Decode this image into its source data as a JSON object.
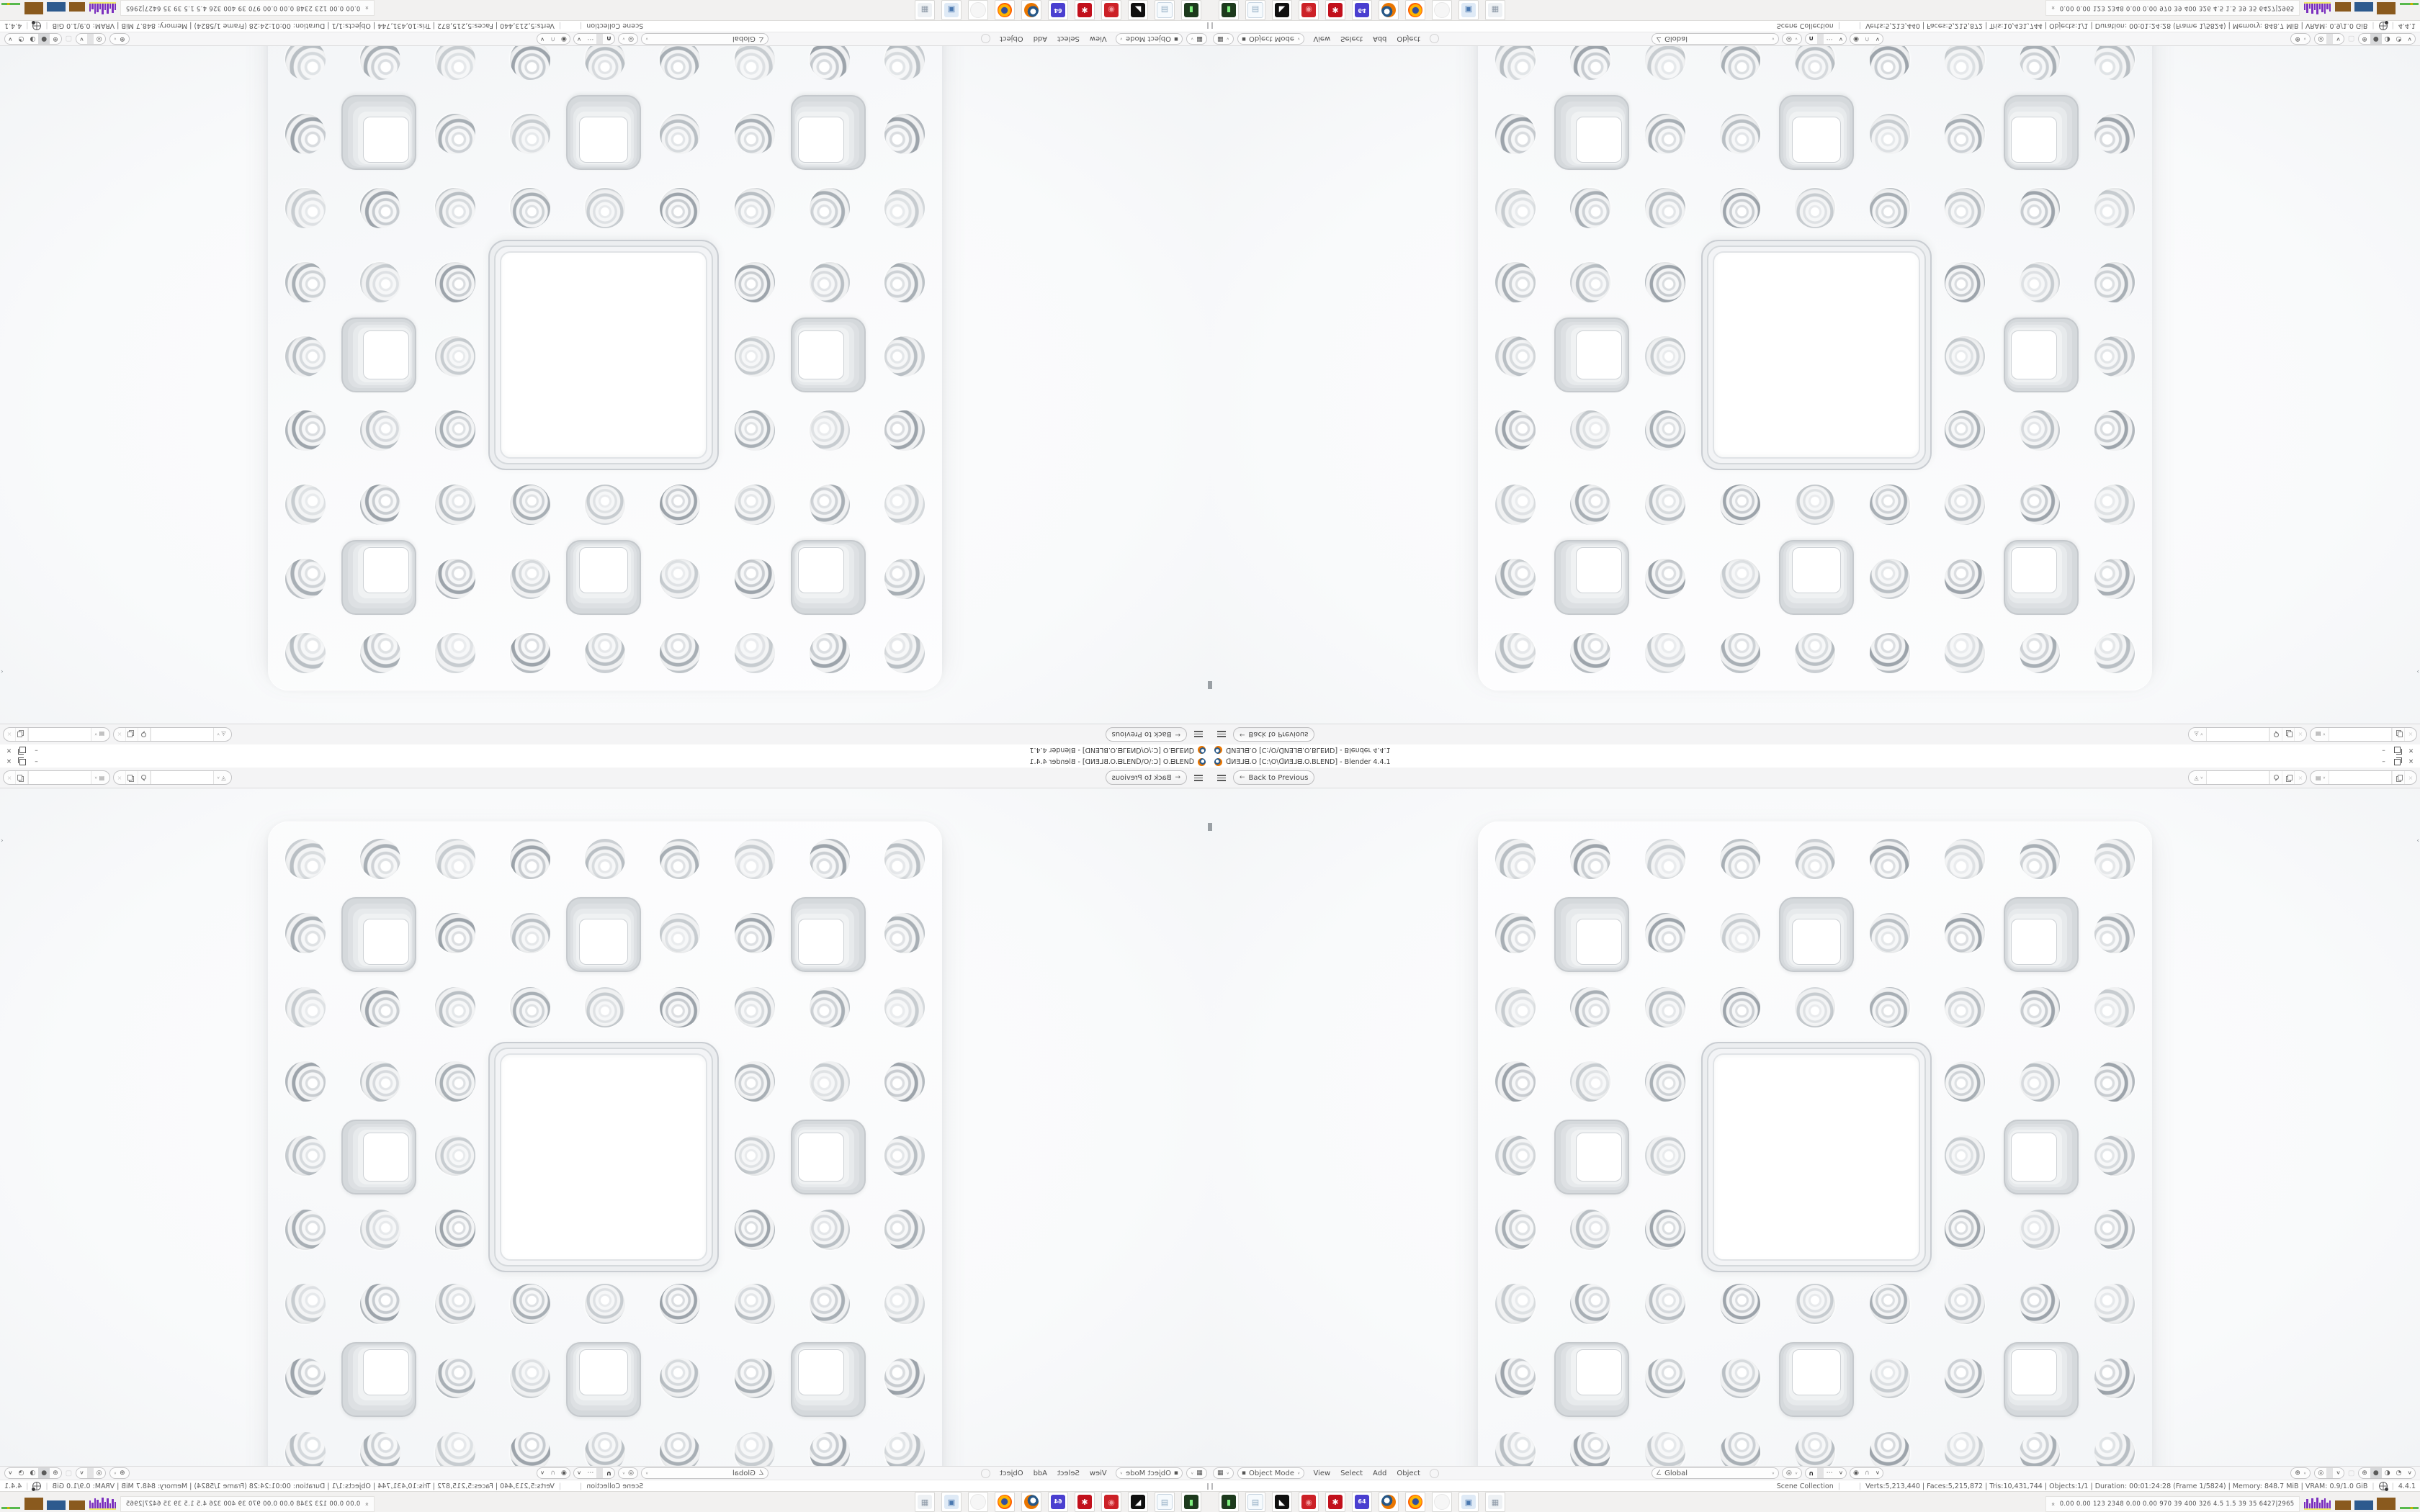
{
  "meta": {
    "app": "Blender",
    "composition": "Single 1680x1050 Blender fullscreen screenshot tiled 2x2 with mirror symmetry",
    "quadrants": [
      "top-left rotated 180",
      "top-right flipped vertically",
      "bottom-left flipped horizontally",
      "bottom-right original"
    ]
  },
  "colors": {
    "accent_orange": "#ea7600",
    "ui_text": "#4a4a4a",
    "topbar_bg": "#f4f4f5",
    "viewport_bg": "#fafbfc",
    "slab": "#fcfcfd",
    "ring_gray": "#aab1b7",
    "tray_purple": "#7b2fbe",
    "tray_brown": "#8a5a1e",
    "tray_blue": "#2d5a8e",
    "tray_yellow": "#f0ec6a",
    "tray_green": "#57b94c"
  },
  "window": {
    "title": "ᗡИƎ⅃ᗺ.O [C:\\O\\ᗡИƎ⅃ᗺ.O.BLEND] - Blender 4.4.1",
    "minimize_glyph": "–",
    "close_glyph": "×"
  },
  "topbar": {
    "back_label": "Back to Previous",
    "back_arrow_glyph": "←",
    "scene_selector": {
      "value": "",
      "icon_glyph": "◬"
    },
    "view_layer_selector": {
      "value": "",
      "icon_glyph": "▤"
    },
    "chevron_glyph": "∨",
    "unlink_glyph": "×"
  },
  "viewport_header": {
    "editor_icon_glyph": "▦",
    "mode_icon_glyph": "▪",
    "mode": "Object Mode",
    "menus": [
      "View",
      "Select",
      "Add",
      "Object"
    ],
    "orientation_icon_glyph": "∠",
    "orientation": "Global",
    "pivot_glyph": "◎",
    "magnet_glyph": "∪",
    "snap_with_glyph": "⋯",
    "prop_edit_glyph": "◉",
    "falloff_glyph": "∩",
    "gizmo_glyph": "⊕",
    "overlay_glyph": "◎",
    "xray_glyph": "▢",
    "shading_glyphs": [
      "⊕",
      "●",
      "◑",
      "◔"
    ],
    "active_shading_index": 1,
    "chevron_glyph": "∨"
  },
  "status_bar": {
    "collection": "Scene Collection",
    "active_object": "",
    "sep": "|",
    "stats": "Verts:5,213,440 | Faces:5,215,872 | Tris:10,431,744 | Objects:1/1 | Duration: 00:01:24:28 (Frame 1/5824) | Memory: 848.7 MiB | VRAM: 0.9/1.0 GiB",
    "version": "4.4.1"
  },
  "taskbar": {
    "apps": [
      {
        "name": "console-app",
        "style": "box",
        "bg": "#1d3a1d",
        "fg": "#7ef07e",
        "glyph": "▮"
      },
      {
        "name": "notepad-app",
        "style": "box",
        "bg": "#f6fafd",
        "fg": "#93addButNo",
        "glyph": "▤"
      },
      {
        "name": "image-viewer-app",
        "style": "box",
        "bg": "#101010",
        "fg": "#ffffff",
        "glyph": "◣"
      },
      {
        "name": "red-dial-app",
        "style": "box",
        "bg": "#cc2127",
        "fg": "#f2989a",
        "glyph": "◉"
      },
      {
        "name": "red-gear-app",
        "style": "box",
        "bg": "#c2101c",
        "fg": "#ffffff",
        "glyph": "✱"
      },
      {
        "name": "floppy-64-app",
        "style": "box",
        "bg": "#4a3fd0",
        "fg": "#ffffff",
        "glyph": "64"
      },
      {
        "name": "blender-app",
        "style": "blender",
        "bg": "#ffffff",
        "fg": "#ea7600",
        "glyph": ""
      },
      {
        "name": "firefox-app",
        "style": "firefox",
        "bg": "#ffffff",
        "fg": "#ff5a00",
        "glyph": ""
      },
      {
        "name": "ghost-app",
        "style": "ghost",
        "bg": "#f6f6f6",
        "fg": "#e8e8e8",
        "glyph": ""
      },
      {
        "name": "display-settings-app",
        "style": "box",
        "bg": "#dfeaf6",
        "fg": "#4a78b0",
        "glyph": "▣"
      },
      {
        "name": "calculator-app",
        "style": "box",
        "bg": "#eef1f4",
        "fg": "#8b97a5",
        "glyph": "▦"
      }
    ],
    "tray": {
      "expand_glyph": "«",
      "text": "0.00 0.00  123  2348 0.00 0.00  970   39   400  326   4.5   1.5   39   35   6427|2965",
      "histogram": [
        9,
        13,
        7,
        14,
        9,
        15,
        8,
        12,
        14,
        8,
        11
      ],
      "blocks": [
        {
          "color": "#8a5a1e",
          "w": 22,
          "h": 13
        },
        {
          "color": "#2d5a8e",
          "w": 26,
          "h": 13
        },
        {
          "color": "#8a5a1e",
          "w": 26,
          "h": 17
        }
      ]
    }
  },
  "fractal": {
    "type": "menger-sponge-face",
    "grid": 9,
    "big_hole_span_cells": 3,
    "medium_square_holes": 8,
    "round_holes": 64,
    "medium_cells": [
      [
        1,
        1
      ],
      [
        1,
        4
      ],
      [
        1,
        7
      ],
      [
        4,
        1
      ],
      [
        4,
        7
      ],
      [
        7,
        1
      ],
      [
        7,
        4
      ],
      [
        7,
        7
      ]
    ],
    "ring_shades": [
      "#b9bfc4",
      "#a8afb5",
      "#c7ccd0",
      "#9da4ab"
    ]
  }
}
